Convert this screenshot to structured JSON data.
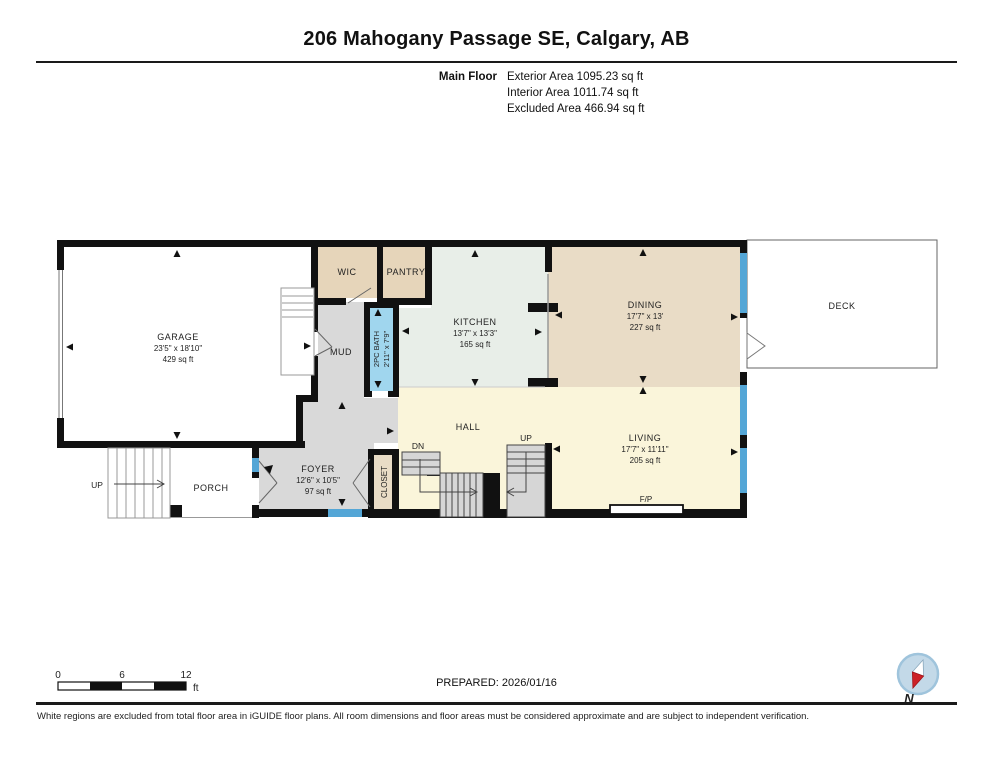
{
  "header": {
    "title": "206 Mahogany Passage SE, Calgary, AB",
    "floor_label": "Main Floor",
    "areas": [
      "Exterior Area 1095.23 sq ft",
      "Interior Area 1011.74 sq ft",
      "Excluded Area 466.94 sq ft"
    ]
  },
  "rooms": {
    "garage": {
      "name": "GARAGE",
      "dims": "23'5\" x 18'10\"",
      "area": "429 sq ft"
    },
    "wic": {
      "name": "WIC"
    },
    "pantry": {
      "name": "PANTRY"
    },
    "mud": {
      "name": "MUD"
    },
    "bath": {
      "name": "2PC BATH",
      "dims": "2'11\" x 7'9\""
    },
    "kitchen": {
      "name": "KITCHEN",
      "dims": "13'7\" x 13'3\"",
      "area": "165 sq ft"
    },
    "dining": {
      "name": "DINING",
      "dims": "17'7\" x 13'",
      "area": "227 sq ft"
    },
    "living": {
      "name": "LIVING",
      "dims": "17'7\" x 11'11\"",
      "area": "205 sq ft"
    },
    "hall": {
      "name": "HALL"
    },
    "foyer": {
      "name": "FOYER",
      "dims": "12'6\" x 10'5\"",
      "area": "97 sq ft"
    },
    "closet": {
      "name": "CLOSET"
    },
    "porch": {
      "name": "PORCH"
    },
    "deck": {
      "name": "DECK"
    },
    "fireplace": {
      "name": "F/P"
    }
  },
  "stairs": {
    "up": "UP",
    "dn": "DN",
    "porch_up": "UP"
  },
  "scale_bar": {
    "tick0": "0",
    "tick6": "6",
    "tick12": "12",
    "unit": "ft"
  },
  "footer": {
    "prepared": "PREPARED: 2026/01/16",
    "disclaimer": "White regions are excluded from total floor area in iGUIDE floor plans. All room dimensions and floor areas must be considered approximate and are subject to independent verification.",
    "compass_label": "N"
  },
  "colors": {
    "wall": "#111111",
    "window_blue": "#54a6d6",
    "bath_blue": "#a0d6ee",
    "room_tan": "#e6d5ba",
    "dining_tan": "#e9dcc6",
    "kitchen_green": "#e8eee8",
    "hall_yellow": "#faf5da",
    "corridor_gray": "#d9d9d9",
    "compass_red": "#cc2127"
  }
}
